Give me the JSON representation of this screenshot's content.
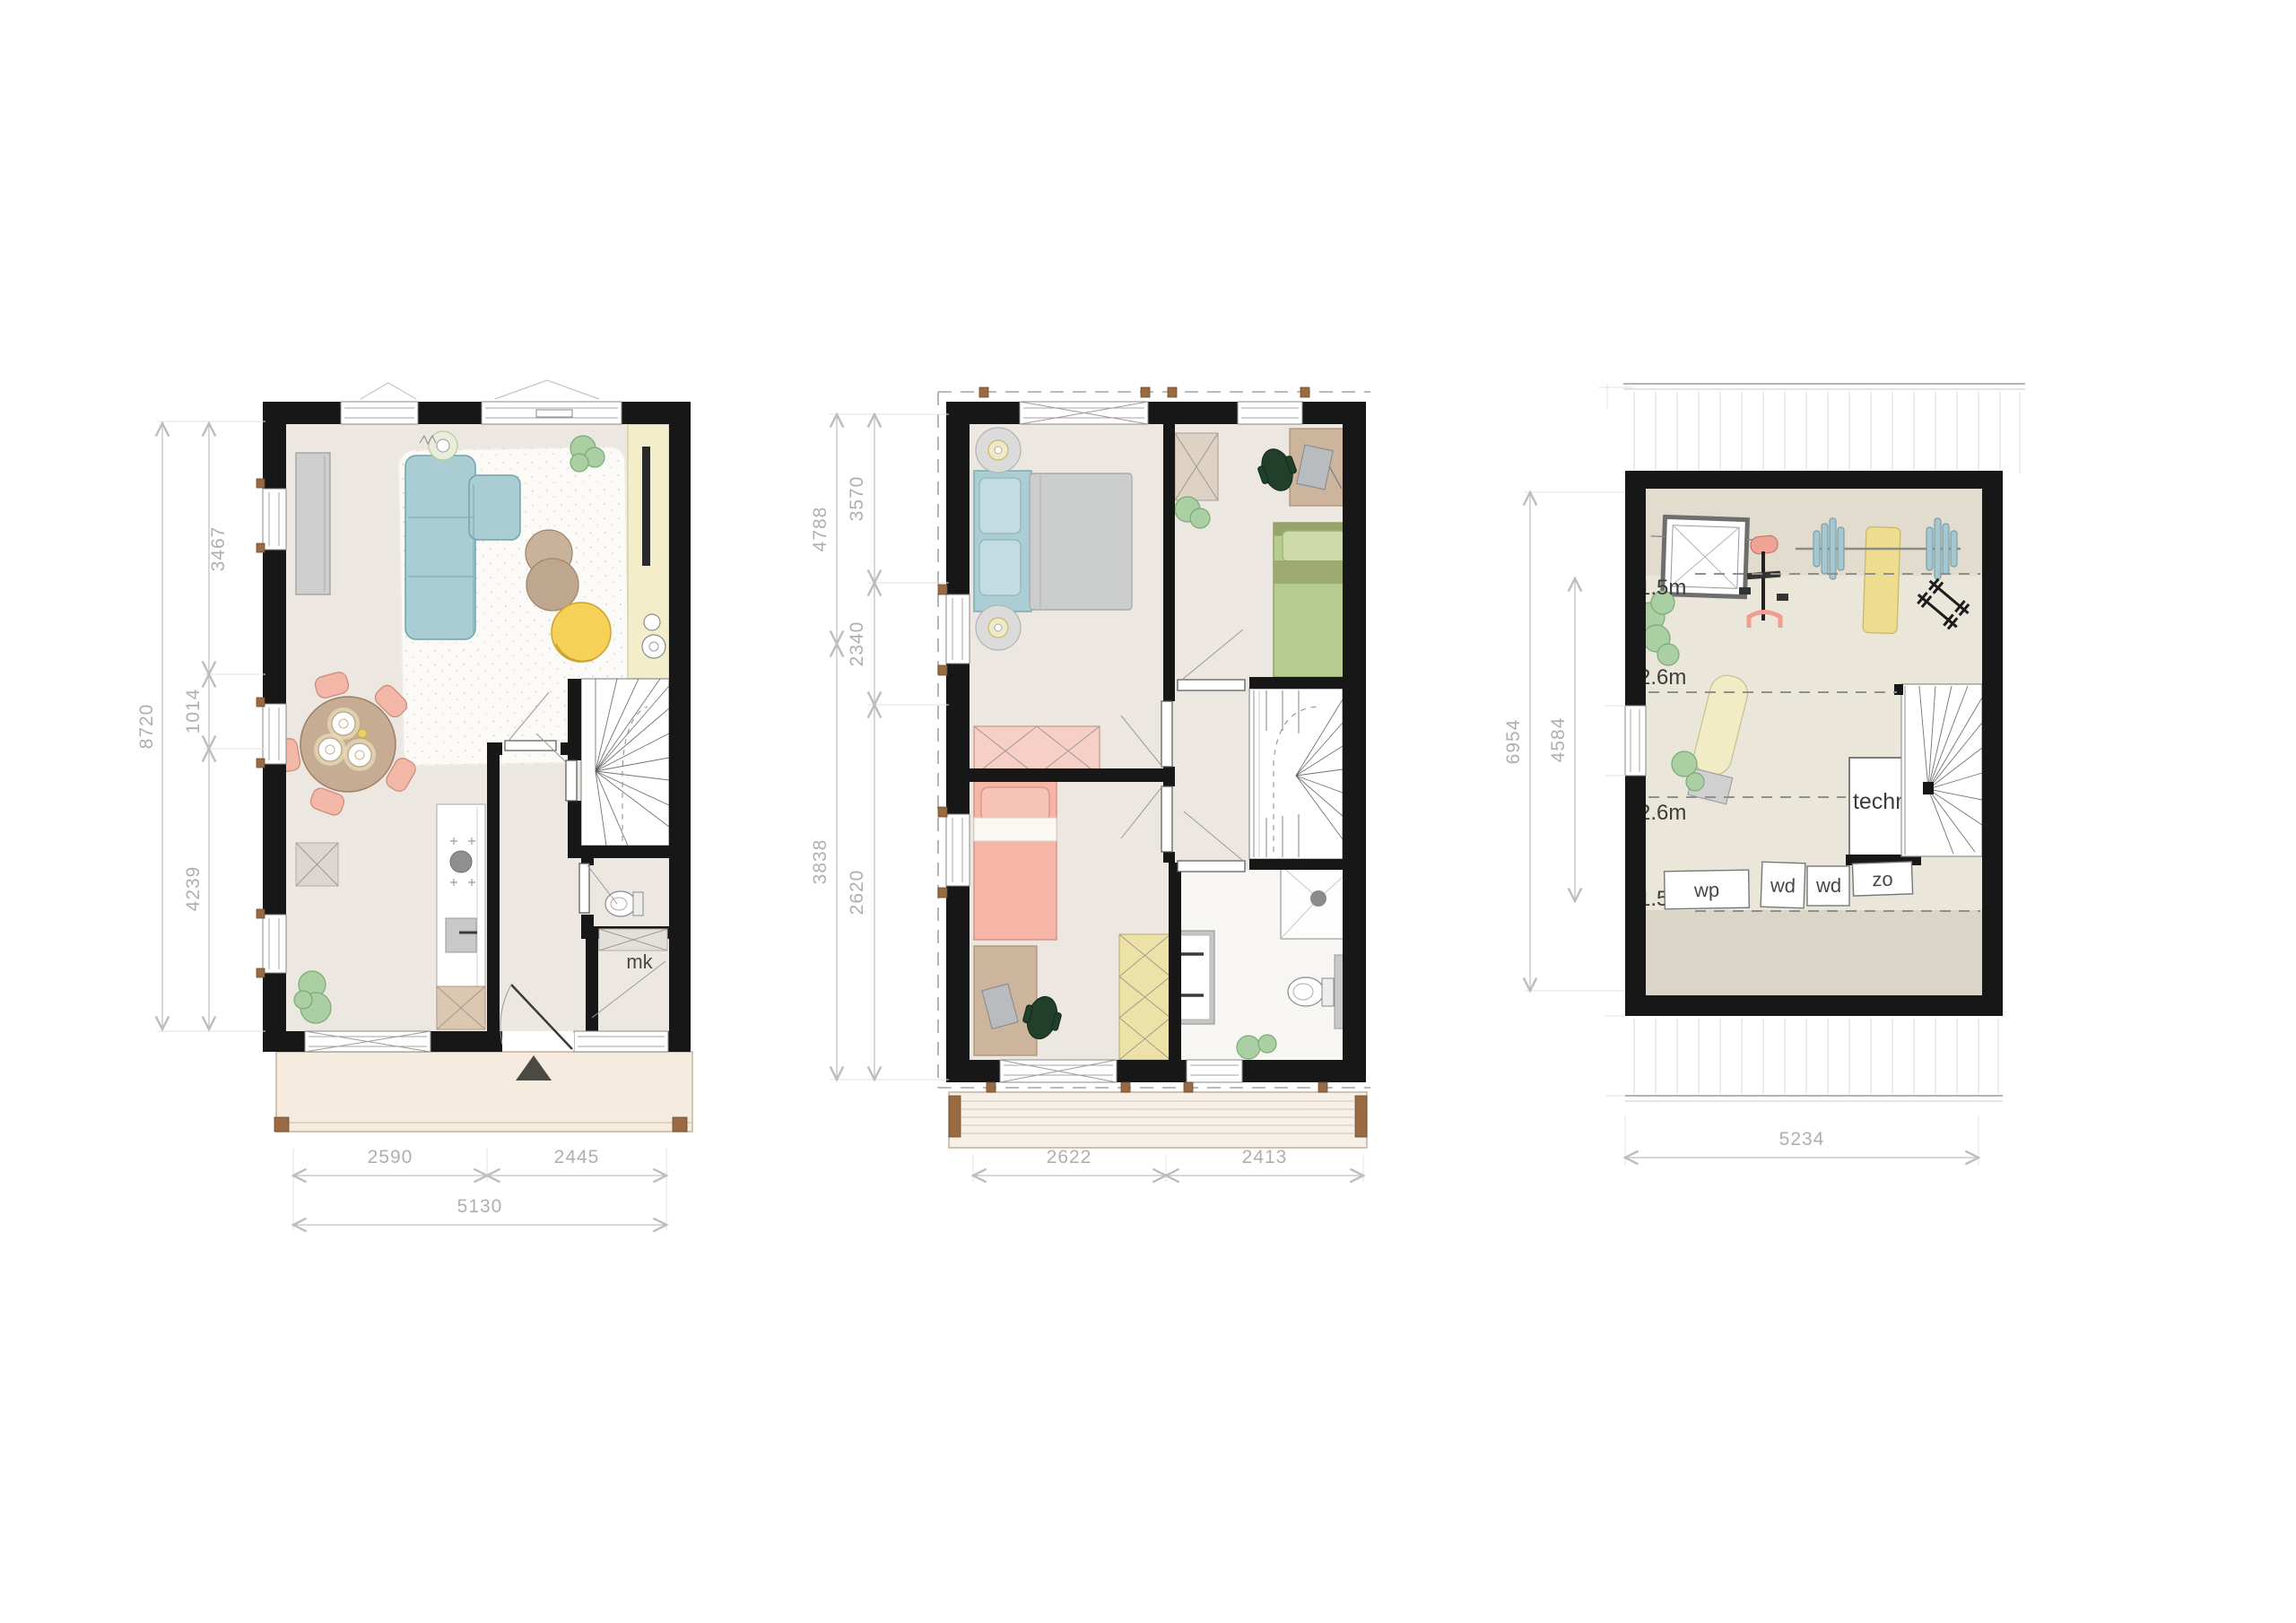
{
  "ground": {
    "left_total": "8720",
    "left_segs": [
      "3467",
      "1014",
      "4239"
    ],
    "bottom_segs": [
      "2590",
      "2445"
    ],
    "bottom_total": "5130",
    "mk": "mk"
  },
  "first": {
    "left_outer": [
      "4788",
      "3838"
    ],
    "left_inner": [
      "3570",
      "2340",
      "2620"
    ],
    "bottom_segs": [
      "2622",
      "2413"
    ]
  },
  "attic": {
    "left_outer": "6954",
    "left_inner": "4584",
    "bottom_total": "5234",
    "levels": [
      "+1.5m",
      "+2.6m",
      "+2.6m",
      "+1.5m"
    ],
    "technical": "techn.",
    "appliances": [
      "wp",
      "wd",
      "wd",
      "zo"
    ]
  },
  "colors": {
    "wall": "#171717",
    "floor": "#ece7e1",
    "attic_floor": "#ebe6da",
    "attic_floor_dark": "#dad5c7",
    "sofa_blue": "#aacdd4",
    "duvet_gray": "#cccecd",
    "bed_pink": "#f5b5a7",
    "bed_green": "#b7cc90",
    "chair_pink": "#f3b7a8",
    "chair_yellow": "#f6d158",
    "counter_yellow": "#f3edca",
    "wardrobe_yellow": "#ece2a8",
    "plant_green": "#a9cfa2",
    "wood_post": "#9a6a42",
    "dim_gray": "#b1aeae",
    "label_dark": "#3c3c3c"
  }
}
